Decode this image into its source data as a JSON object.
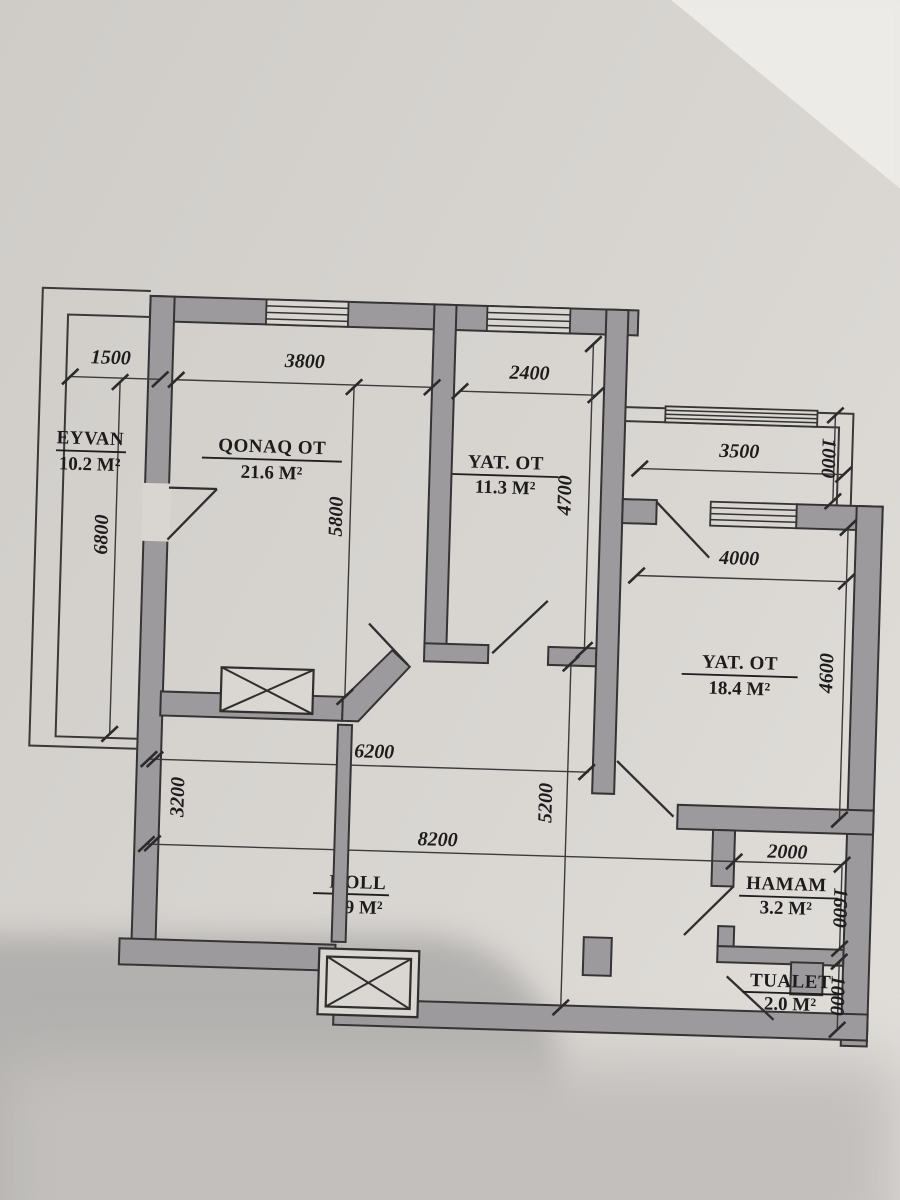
{
  "plan": {
    "rooms": {
      "eyvan": {
        "name": "EYVAN",
        "area": "10.2 M²"
      },
      "qonaq": {
        "name": "QONAQ OT",
        "area": "21.6 M²"
      },
      "yat_kicik": {
        "name": "YAT. OT",
        "area": "11.3 M²"
      },
      "yat_boyuk": {
        "name": "YAT. OT",
        "area": "18.4 M²"
      },
      "holl": {
        "name": "HOLL",
        "area": "9 M²"
      },
      "hamam": {
        "name": "HAMAM",
        "area": "3.2 M²"
      },
      "tualet": {
        "name": "TUALET",
        "area": "2.0 M²"
      }
    },
    "dims": {
      "w1500": "1500",
      "w3800": "3800",
      "w2400": "2400",
      "w3500": "3500",
      "w4000": "4000",
      "w6200": "6200",
      "w8200": "8200",
      "w2000": "2000",
      "h6800": "6800",
      "h5800": "5800",
      "h4700": "4700",
      "h3200": "3200",
      "h5200": "5200",
      "h4600": "4600",
      "h1000_balcony": "1000",
      "h1600": "1600",
      "h1000_tualet": "1000"
    }
  }
}
